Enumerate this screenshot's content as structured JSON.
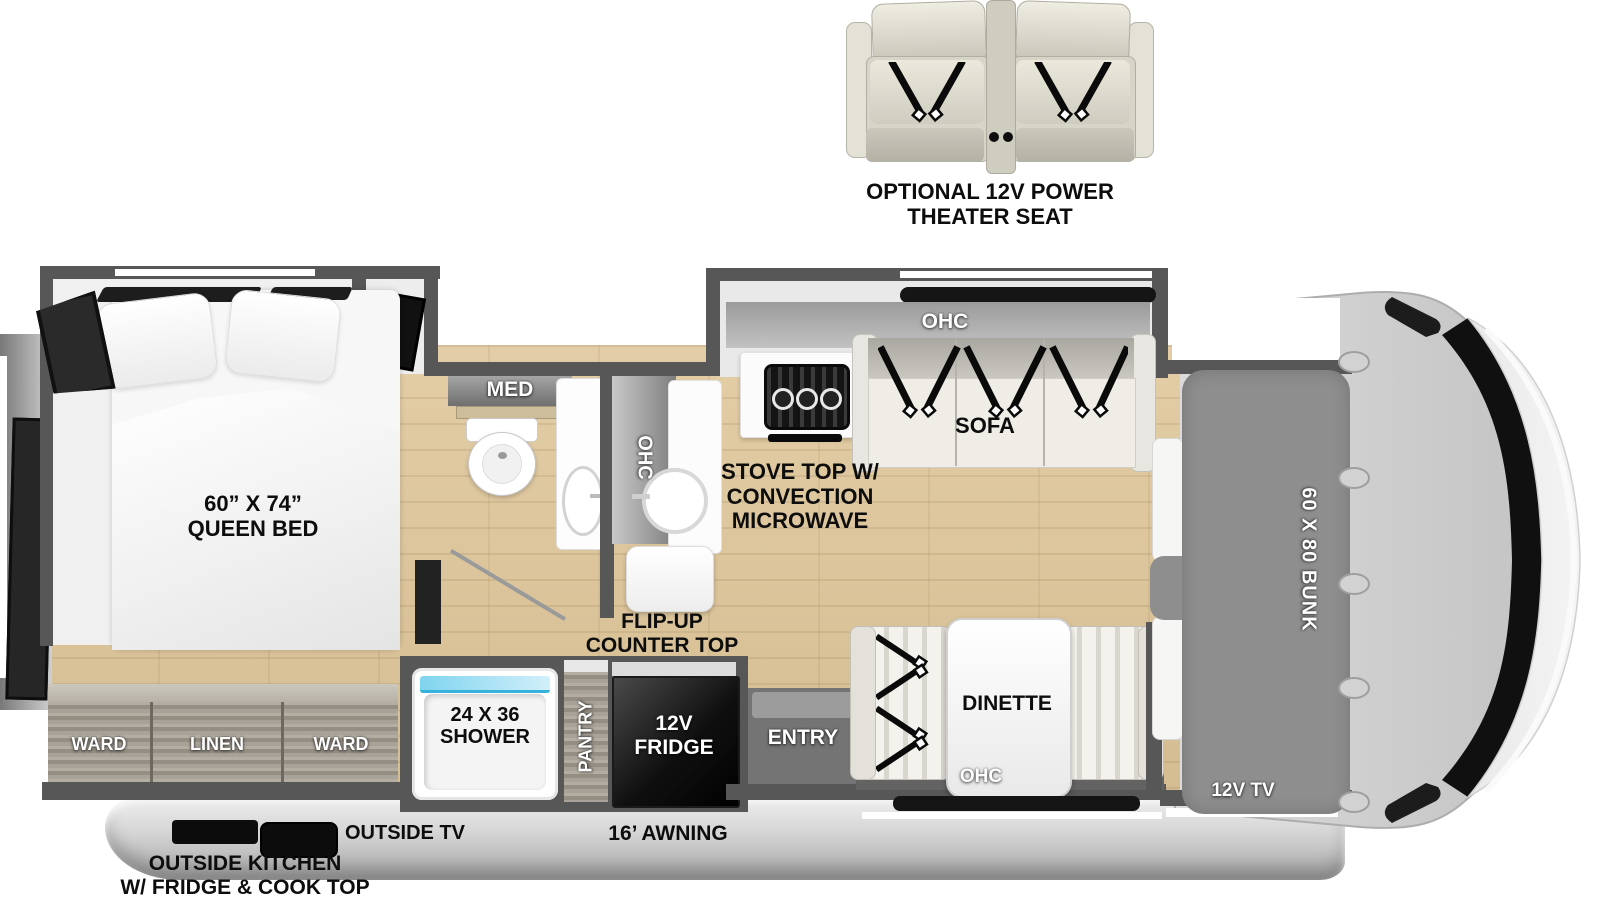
{
  "optional_feature": {
    "line1": "OPTIONAL 12V POWER",
    "line2": "THEATER SEAT"
  },
  "bedroom": {
    "bed_line1": "60” X 74”",
    "bed_line2": "QUEEN BED",
    "med": "MED",
    "ward_left": "WARD",
    "linen": "LINEN",
    "ward_right": "WARD"
  },
  "kitchen": {
    "ohc_vertical": "OHC",
    "stove_line1": "STOVE TOP W/",
    "stove_line2": "CONVECTION",
    "stove_line3": "MICROWAVE",
    "flip_line1": "FLIP-UP",
    "flip_line2": "COUNTER TOP",
    "pantry": "PANTRY",
    "fridge_line1": "12V",
    "fridge_line2": "FRIDGE"
  },
  "living": {
    "ohc_sofa": "OHC",
    "sofa": "SOFA",
    "dinette": "DINETTE",
    "ohc_dinette": "OHC",
    "entry": "ENTRY"
  },
  "bath": {
    "shower_line1": "24 X 36",
    "shower_line2": "SHOWER"
  },
  "front": {
    "bunk": "60 X 80 BUNK",
    "tv": "12V TV"
  },
  "exterior": {
    "outside_tv": "OUTSIDE TV",
    "awning": "16’ AWNING",
    "outside_kitchen_line1": "OUTSIDE KITCHEN",
    "outside_kitchen_line2": "W/ FRIDGE & COOK TOP"
  },
  "colors": {
    "wall": "#575757",
    "floor_wood": "#d9c29b",
    "shower_blue": "#8ed6ee",
    "fridge_black": "#101010",
    "bunk_gray": "#8e8e8e",
    "cab_body_gray": "#d6d6d6",
    "label_black": "#0d0d0d",
    "label_white": "#ffffff"
  }
}
